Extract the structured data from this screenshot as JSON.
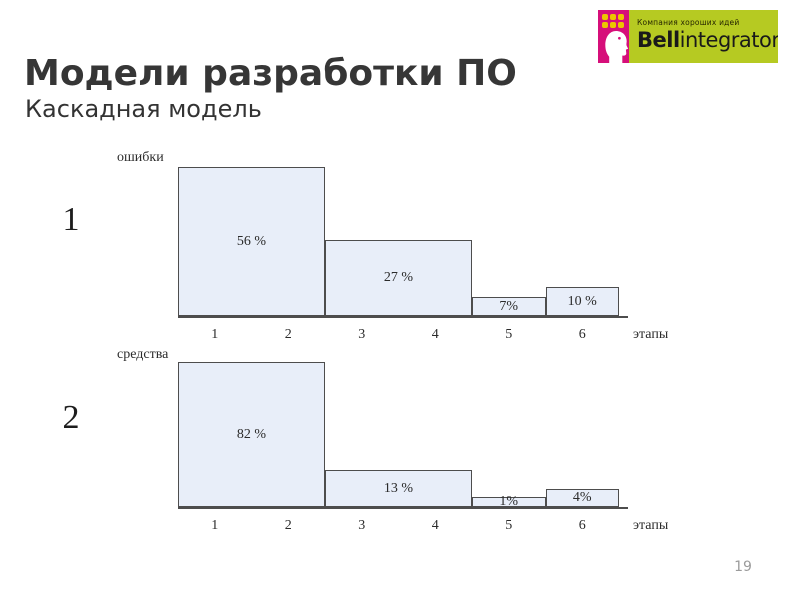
{
  "slide": {
    "title": "Модели разработки ПО",
    "subtitle": "Каскадная модель",
    "page_number": "19",
    "chart_markers": [
      "1",
      "2"
    ]
  },
  "logo": {
    "tagline": "Компания хороших идей",
    "brand_bold": "Bell",
    "brand_rest": "integrator",
    "colors": {
      "green": "#b6ca22",
      "pink": "#d60f7a",
      "yellow": "#ecc500"
    }
  },
  "colors": {
    "bar_fill": "#e8eef9",
    "bar_border": "#4d4d4d",
    "title_text": "#363636",
    "page_number": "#9b9b9b"
  },
  "chart_data": [
    {
      "type": "bar",
      "name": "errors-by-stage",
      "title": "",
      "ylabel": "ошибки",
      "xlabel": "этапы",
      "categories": [
        "1",
        "2",
        "3",
        "4",
        "5",
        "6"
      ],
      "bars": [
        {
          "label": "56 %",
          "value": 56,
          "stages": [
            1,
            2
          ]
        },
        {
          "label": "27 %",
          "value": 27,
          "stages": [
            3,
            4
          ]
        },
        {
          "label": "7%",
          "value": 7,
          "stages": [
            5,
            5
          ]
        },
        {
          "label": "10 %",
          "value": 10,
          "stages": [
            6,
            6
          ]
        }
      ],
      "ylim": [
        0,
        60
      ],
      "grid": false,
      "legend": "none",
      "px_heights": [
        149,
        76,
        19,
        29
      ]
    },
    {
      "type": "bar",
      "name": "costs-by-stage",
      "title": "",
      "ylabel": "средства",
      "xlabel": "этапы",
      "categories": [
        "1",
        "2",
        "3",
        "4",
        "5",
        "6"
      ],
      "bars": [
        {
          "label": "82 %",
          "value": 82,
          "stages": [
            1,
            2
          ]
        },
        {
          "label": "13 %",
          "value": 13,
          "stages": [
            3,
            4
          ]
        },
        {
          "label": "1%",
          "value": 1,
          "stages": [
            5,
            5
          ]
        },
        {
          "label": "4%",
          "value": 4,
          "stages": [
            6,
            6
          ]
        }
      ],
      "ylim": [
        0,
        85
      ],
      "grid": false,
      "legend": "none",
      "px_heights": [
        145,
        37,
        10,
        18
      ]
    }
  ]
}
